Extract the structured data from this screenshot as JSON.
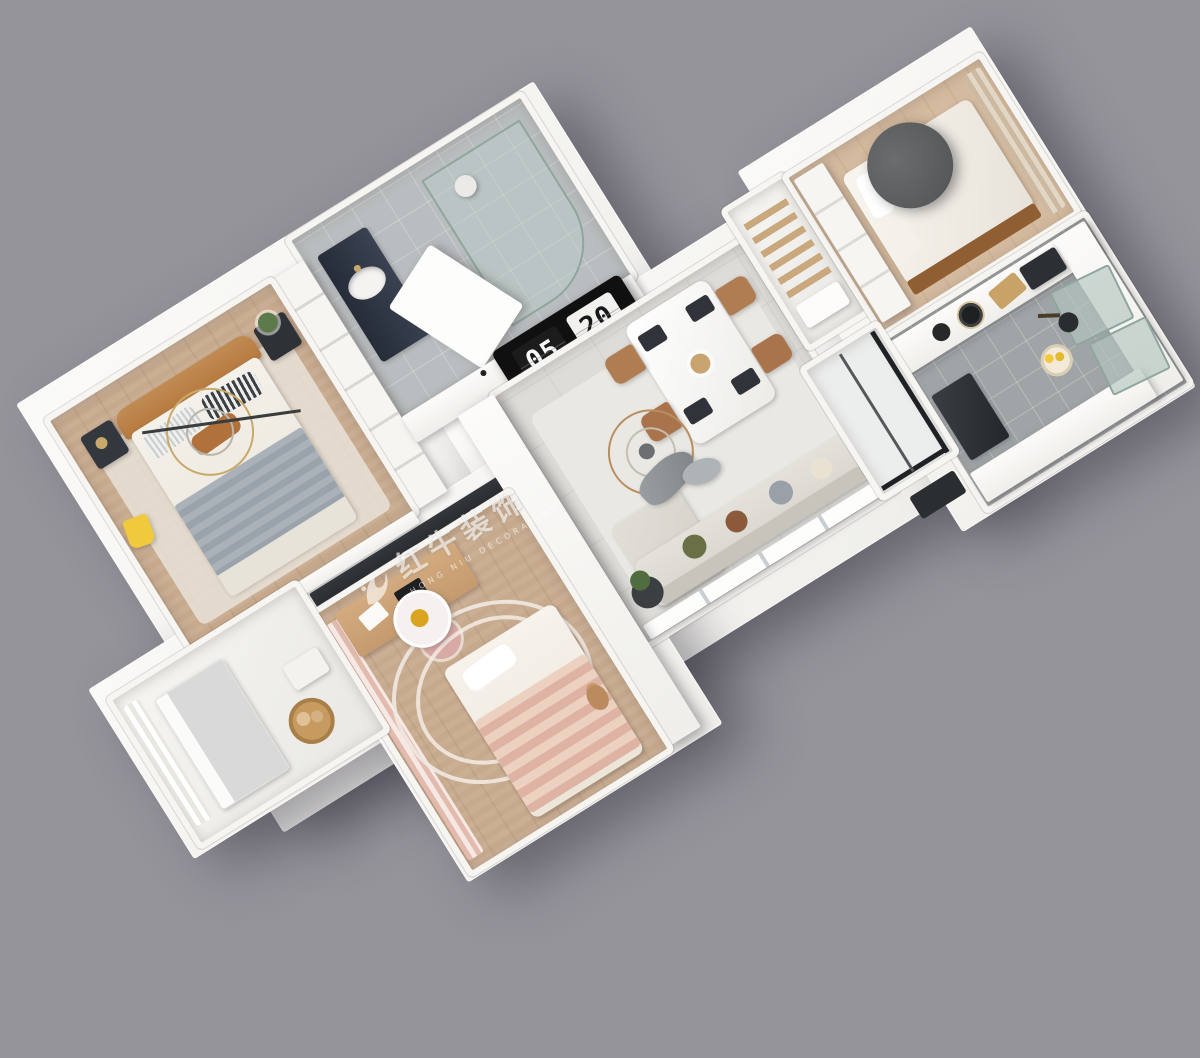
{
  "background_color": "#96949B",
  "wall_sign": {
    "left": "05",
    "right": "20"
  },
  "watermark": {
    "logo": "bull-logo",
    "title": "红牛装饰",
    "subtitle": "HONG NIU DECORATION"
  },
  "palette": {
    "wall_white": "#F7F5F2",
    "floor_wood": "#C7A98D",
    "floor_tile_living": "#DEDCD8",
    "floor_tile_bath": "#B9BDBF",
    "floor_tile_kitchen": "#9FA4A6",
    "sofa_gray": "#D8D5CE",
    "bed_headboard_tan": "#B5793F",
    "blanket_gray": "#9AA2AB",
    "kids_pink": "#E3BBAE",
    "accent_yellow": "#F0C93C",
    "glass_green": "#B3C4BE",
    "dark_charcoal": "#26292C",
    "brass": "#C9A96A"
  },
  "rooms_depicted": [
    "bathroom",
    "master-bedroom",
    "kids-bedroom",
    "laundry-balcony",
    "living-dining",
    "hallway-closet",
    "second-bedroom",
    "kitchen",
    "small-balcony"
  ]
}
